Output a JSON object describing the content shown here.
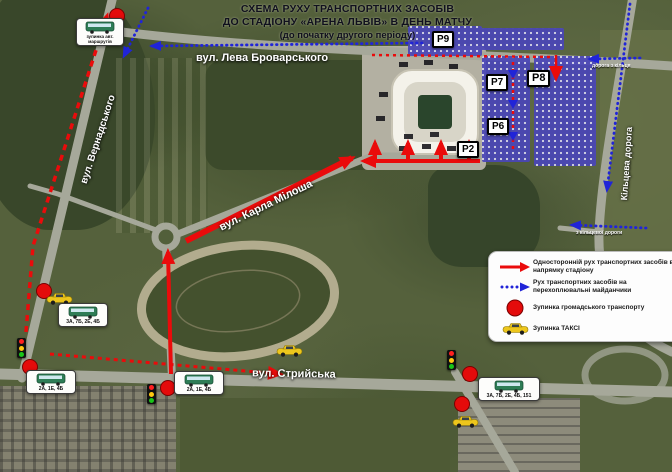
{
  "title": {
    "line1": "СХЕМА РУХУ ТРАНСПОРТНИХ ЗАСОБІВ",
    "line2": "ДО СТАДІОНУ «АРЕНА ЛЬВІВ» В ДЕНЬ МАТЧУ",
    "line3": "(до початку другого періоду)"
  },
  "streets": {
    "brovarskoho": "вул. Лева Броварського",
    "vernadskoho": "вул. Вернадського",
    "miklosha": "вул. Карла Мілоша",
    "stryiska": "вул. Стрийська",
    "kiltseva": "Кільцева дорога",
    "ring_entry_top": "дорога з кільця",
    "ring_entry_mid": "з кільцевої дороги"
  },
  "parkings": [
    {
      "label": "P9"
    },
    {
      "label": "P7"
    },
    {
      "label": "P8"
    },
    {
      "label": "P6"
    },
    {
      "label": "P2"
    }
  ],
  "legend": {
    "items": [
      {
        "icon": "red-arrow",
        "text": "Односторонній рух транспортних засобів в напрямку стадіону"
      },
      {
        "icon": "blue-dotted-arrow",
        "text": "Рух транспортних засобів на перехоплювальні майданчики"
      },
      {
        "icon": "red-circle",
        "text": "Зупинка громадського транспорту"
      },
      {
        "icon": "taxi",
        "text": "Зупинка ТАКСІ"
      }
    ]
  },
  "bus_stops": [
    {
      "routes": "3А, 7Б, 2Е, 4Б"
    },
    {
      "routes": "2А, 1Е, 4Б"
    },
    {
      "routes": "2А, 1Е, 4Б"
    },
    {
      "routes": "3А, 7Б, 2Е, 4Б, 151"
    },
    {
      "caption": "зупинка авт. маршрутів"
    }
  ],
  "colors": {
    "route_to_stadium": "#ea0b0b",
    "route_parking": "#2024d8",
    "parking_fill": "#4a46b8",
    "stop": "#e40b0b",
    "taxi": "#edc61c"
  }
}
